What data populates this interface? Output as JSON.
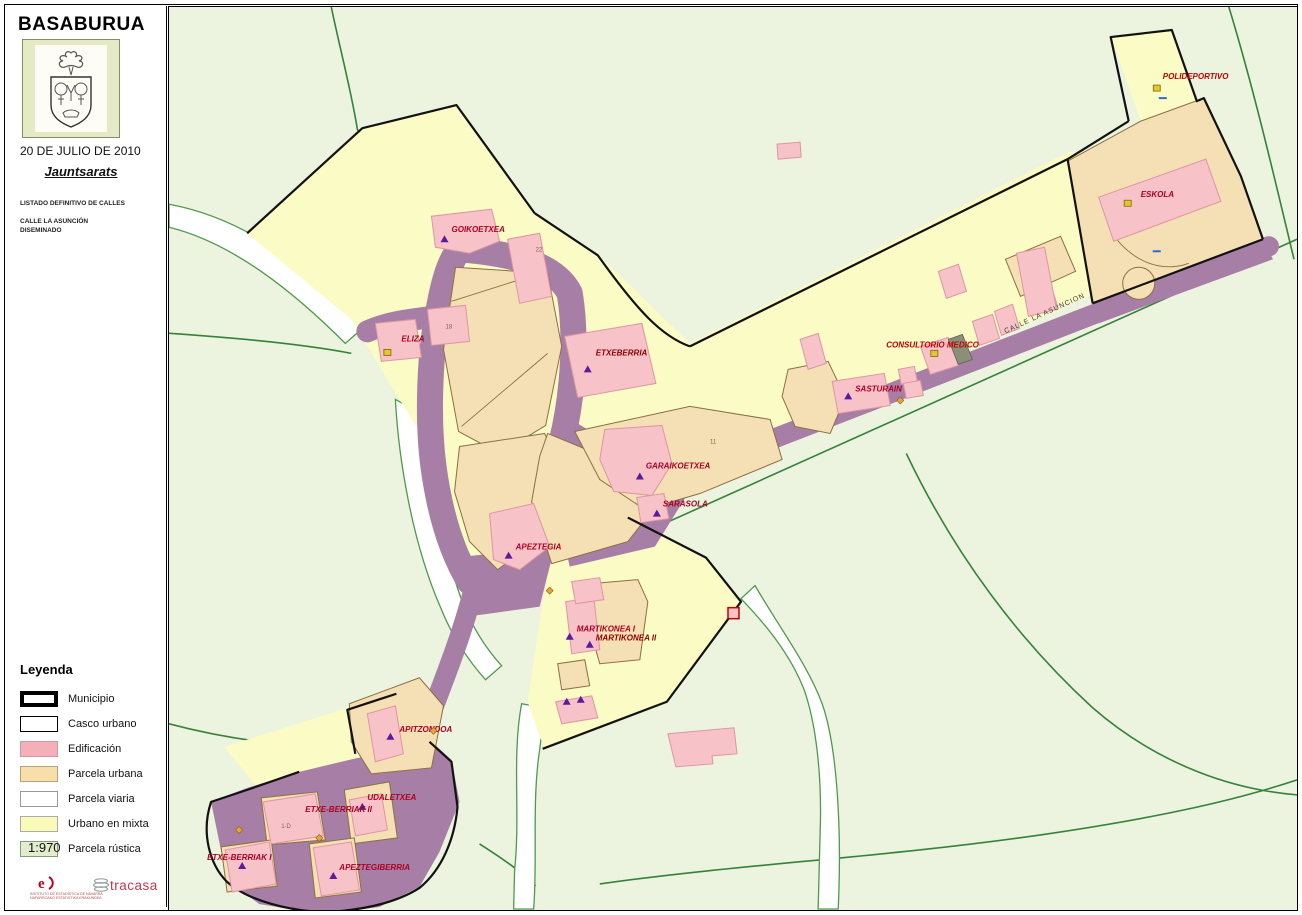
{
  "sidebar": {
    "title": "BASABURUA",
    "date": "20 DE JULIO DE 2010",
    "subtitle": "Jauntsarats",
    "line1": "LISTADO DEFINITIVO DE CALLES",
    "line2": "CALLE LA ASUNCIÓN",
    "line3": "DISEMINADO",
    "legend": {
      "title": "Leyenda",
      "items": [
        {
          "label": "Municipio",
          "fill": "#FFFFFF",
          "border": "#000000",
          "bw": 4
        },
        {
          "label": "Casco urbano",
          "fill": "#FFFFFF",
          "border": "#000000",
          "bw": 1.5
        },
        {
          "label": "Edificación",
          "fill": "#F5AFB8",
          "border": "#cc9aa4",
          "bw": 1
        },
        {
          "label": "Parcela urbana",
          "fill": "#F8DFA9",
          "border": "#b9a27a",
          "bw": 1
        },
        {
          "label": "Parcela viaria",
          "fill": "#FFFFFF",
          "border": "#999999",
          "bw": 1
        },
        {
          "label": "Urbano en mixta",
          "fill": "#FBFBB9",
          "border": "#aaaaaa",
          "bw": 1
        },
        {
          "label": "Parcela rústica",
          "fill": "#E3EDCD",
          "border": "#7e9e7e",
          "bw": 1
        }
      ]
    },
    "scale": "1:970",
    "logos": {
      "ien_caption_line1": "INSTITUTO DE ESTADÍSTICA DE NAVARRA",
      "ien_caption_line2": "NAFARROAKO ESTATISTIKA ERAKUNDEA",
      "tracasa": "tracasa"
    }
  },
  "map": {
    "street_label": {
      "text": "CALLE LA ASUNCION",
      "x": 1005,
      "y": 332,
      "rotate": -24.5
    },
    "labels": [
      {
        "text": "GOIKOETXEA",
        "x": 452,
        "y": 231,
        "color": "#AD0021",
        "marker": "tri",
        "mx": 445,
        "my": 238
      },
      {
        "text": "ELIZA",
        "x": 402,
        "y": 340,
        "color": "#AD0021",
        "marker": "ysq",
        "mx": 388,
        "my": 351
      },
      {
        "text": "ETXEBERRIA",
        "x": 596,
        "y": 354,
        "color": "#8B0000",
        "marker": "tri",
        "mx": 588,
        "my": 368
      },
      {
        "text": "POLIDEPORTIVO",
        "x": 1162,
        "y": 78,
        "color": "#C00000",
        "marker": "ysq",
        "mx": 1156,
        "my": 87
      },
      {
        "text": "ESKOLA",
        "x": 1140,
        "y": 196,
        "color": "#AD0021",
        "marker": "ysq",
        "mx": 1127,
        "my": 202
      },
      {
        "text": "CONSULTORIO MEDICO",
        "x": 886,
        "y": 346,
        "color": "#C00000",
        "marker": "ysq",
        "mx": 934,
        "my": 352
      },
      {
        "text": "SASTURAIN",
        "x": 855,
        "y": 390,
        "color": "#AD0021",
        "marker": "tri",
        "mx": 848,
        "my": 395
      },
      {
        "text": "GARAIKOETXEA",
        "x": 646,
        "y": 467,
        "color": "#AD0021",
        "marker": "tri",
        "mx": 640,
        "my": 475
      },
      {
        "text": "SARASOLA",
        "x": 663,
        "y": 505,
        "color": "#AD0021",
        "marker": "tri",
        "mx": 657,
        "my": 512
      },
      {
        "text": "APEZTEGIA",
        "x": 516,
        "y": 548,
        "color": "#AD0021",
        "marker": "tri",
        "mx": 509,
        "my": 554
      },
      {
        "text": "MARTIKONEA I",
        "x": 577,
        "y": 630,
        "color": "#AD0021",
        "marker": "tri",
        "mx": 570,
        "my": 635
      },
      {
        "text": "MARTIKONEA II",
        "x": 596,
        "y": 639,
        "color": "#8B0000",
        "marker": "tri",
        "mx": 590,
        "my": 643
      },
      {
        "text": "APITZONDOA",
        "x": 400,
        "y": 730,
        "color": "#AD0021",
        "marker": "tri",
        "mx": 391,
        "my": 735
      },
      {
        "text": "UDALETXEA",
        "x": 368,
        "y": 798,
        "color": "#AD0021",
        "marker": "tri",
        "mx": 363,
        "my": 805
      },
      {
        "text": "ETXE-BERRIAK II",
        "x": 306,
        "y": 810,
        "color": "#AD0021",
        "marker": "none",
        "mx": 0,
        "my": 0
      },
      {
        "text": "ETXE-BERRIAK I",
        "x": 208,
        "y": 858,
        "color": "#AD0021",
        "marker": "tri",
        "mx": 243,
        "my": 864
      },
      {
        "text": "APEZTEGIBERRIA",
        "x": 340,
        "y": 868,
        "color": "#AD0021",
        "marker": "tri",
        "mx": 334,
        "my": 874
      }
    ],
    "extra_markers": {
      "triangles": [
        [
          567,
          700
        ],
        [
          581,
          698
        ]
      ],
      "diamonds": [
        [
          900,
          399
        ],
        [
          434,
          729
        ],
        [
          320,
          836
        ],
        [
          240,
          828
        ],
        [
          550,
          589
        ]
      ],
      "bluemarks": [
        [
          1162,
          97
        ],
        [
          1156,
          250
        ]
      ]
    },
    "parcel_numbers": [
      {
        "text": "22",
        "x": 536,
        "y": 250
      },
      {
        "text": "18",
        "x": 446,
        "y": 327
      },
      {
        "text": "11",
        "x": 710,
        "y": 442
      },
      {
        "text": "1-D",
        "x": 282,
        "y": 826
      }
    ],
    "colors": {
      "rustic": "#ECF3DE",
      "mixta": "#FBFBC6",
      "urbana": "#F5DFB5",
      "edificacion": "#F8C2C9",
      "road": "#A77EA6",
      "boundary": "#121212",
      "greenline": "#35823B",
      "marker_triangle": "#5C1A9E",
      "marker_square": "#E9C431"
    }
  }
}
